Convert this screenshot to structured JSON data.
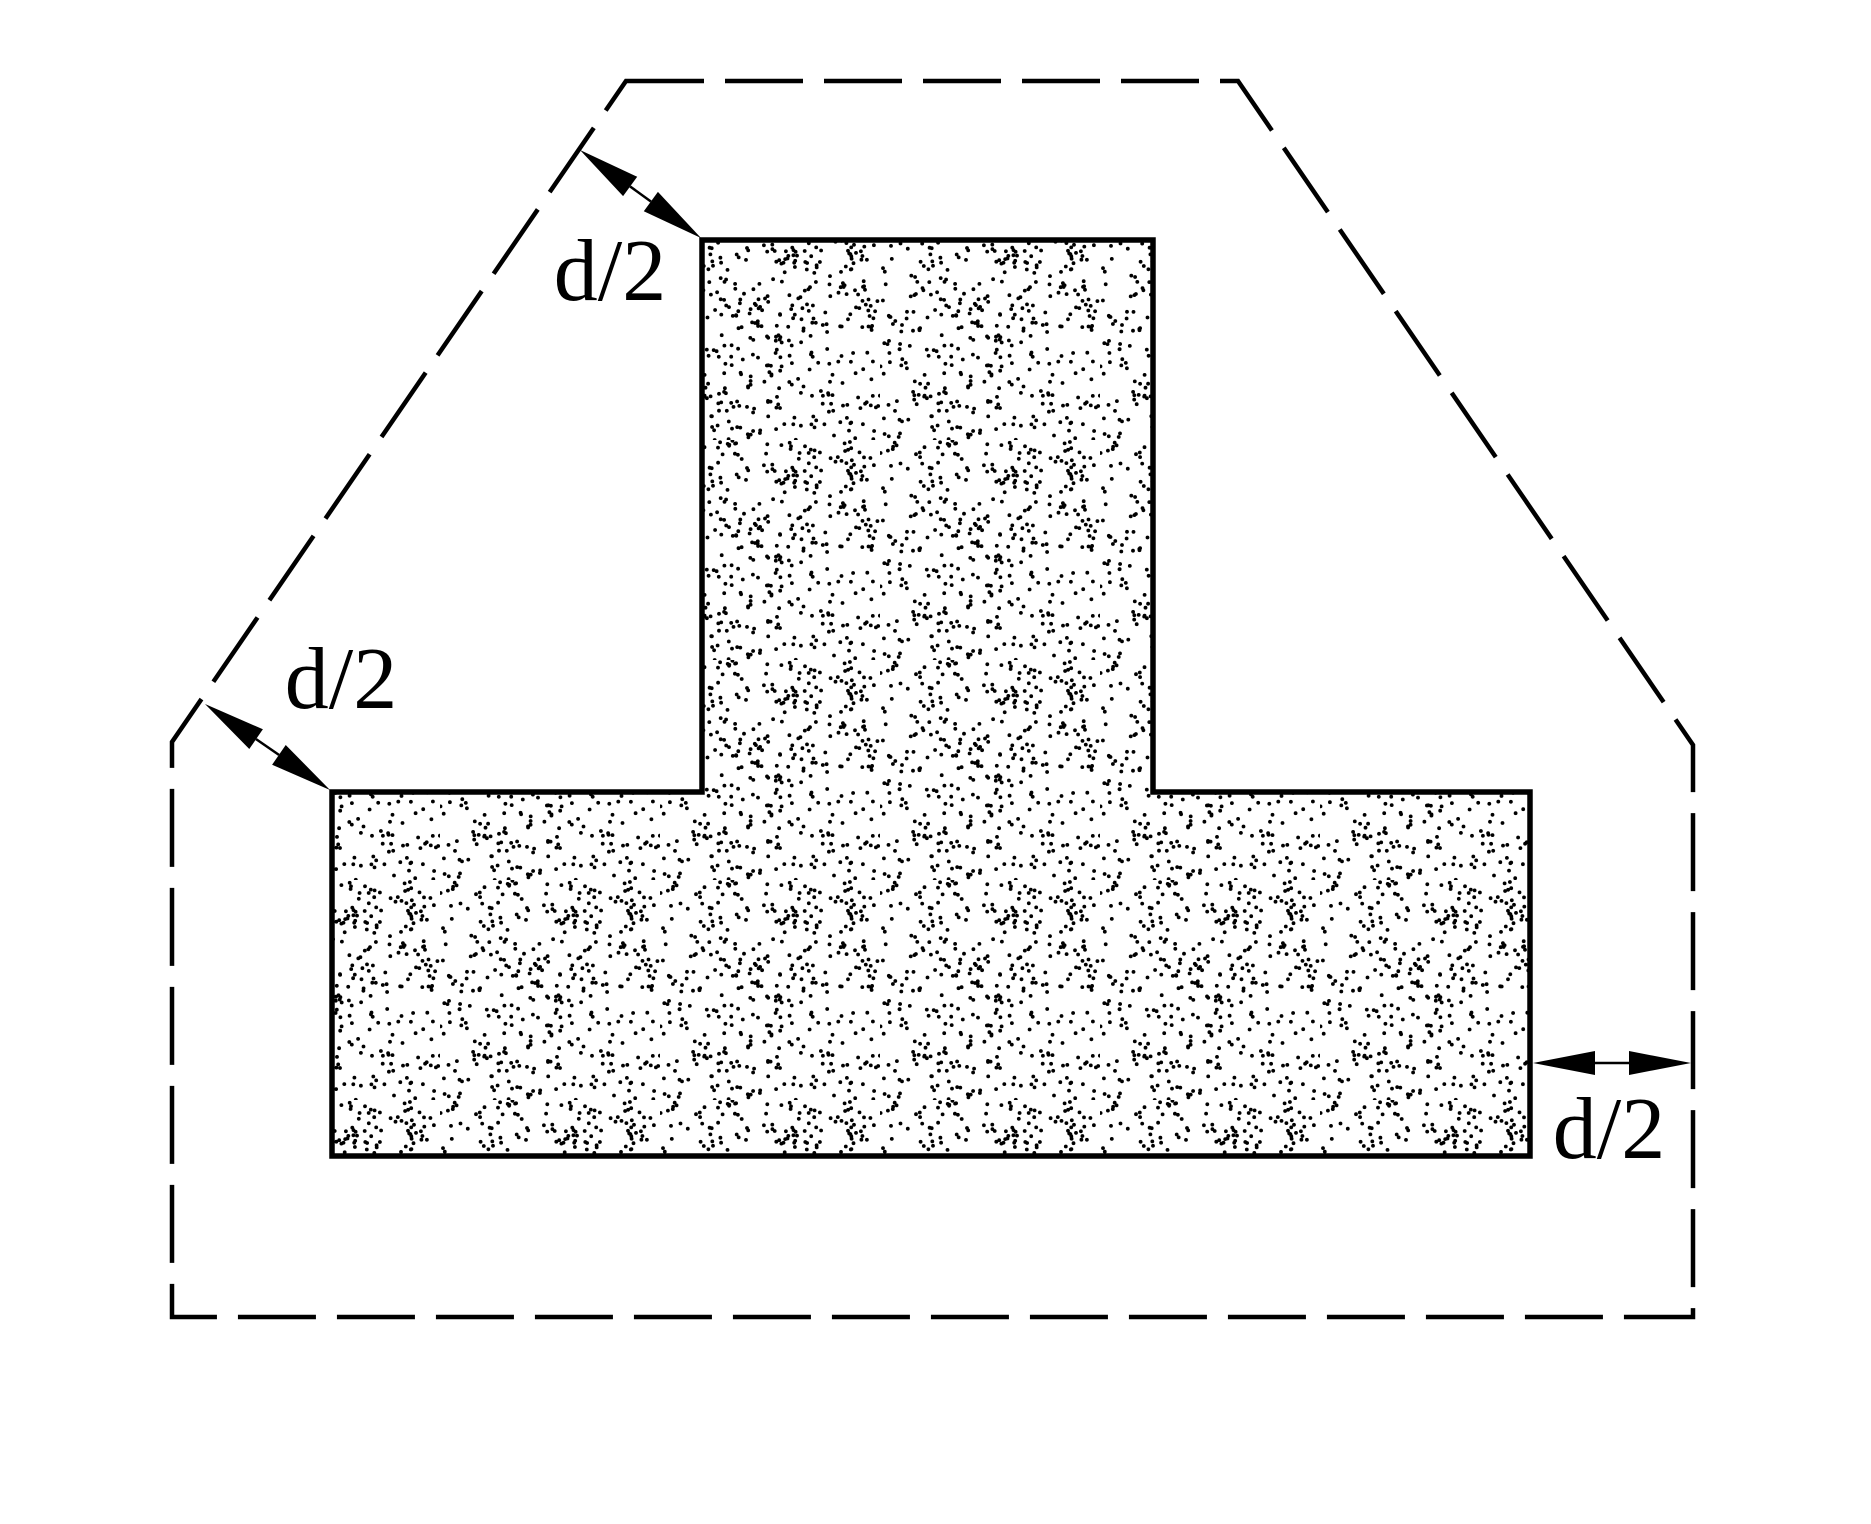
{
  "figure": {
    "canvas_width": 1871,
    "canvas_height": 1524,
    "background_color": "#ffffff",
    "ink_color": "#000000"
  },
  "t_section": {
    "fill": "stipple-dots",
    "outline_width": 5.5,
    "outline_points": [
      [
        702,
        240
      ],
      [
        1153,
        240
      ],
      [
        1153,
        792
      ],
      [
        1530,
        792
      ],
      [
        1530,
        1156
      ],
      [
        332,
        1156
      ],
      [
        332,
        792
      ],
      [
        702,
        792
      ]
    ]
  },
  "critical_perimeter": {
    "stroke_width": 4.5,
    "dash_pattern": [
      78,
      21
    ],
    "points": [
      [
        626,
        81
      ],
      [
        1238,
        81
      ],
      [
        1693,
        745
      ],
      [
        1693,
        1317
      ],
      [
        172,
        1317
      ],
      [
        172,
        742
      ]
    ]
  },
  "stipple": {
    "tile_size": 220,
    "dots_per_tile": 460,
    "dot_radius": 1.9,
    "seed": 1337
  },
  "arrow_style": {
    "head_length": 62,
    "head_half_width": 12,
    "shaft_width": 2.5
  },
  "label_style": {
    "font_size": 88
  },
  "dimensions": [
    {
      "text": "d/2",
      "from": [
        580,
        150
      ],
      "to": [
        701,
        238
      ],
      "label_x": 610,
      "label_y": 300
    },
    {
      "text": "d/2",
      "from": [
        205,
        704
      ],
      "to": [
        330,
        790
      ],
      "label_x": 341,
      "label_y": 708
    },
    {
      "text": "d/2",
      "from": [
        1691,
        1063
      ],
      "to": [
        1533,
        1063
      ],
      "label_x": 1609,
      "label_y": 1158
    }
  ]
}
